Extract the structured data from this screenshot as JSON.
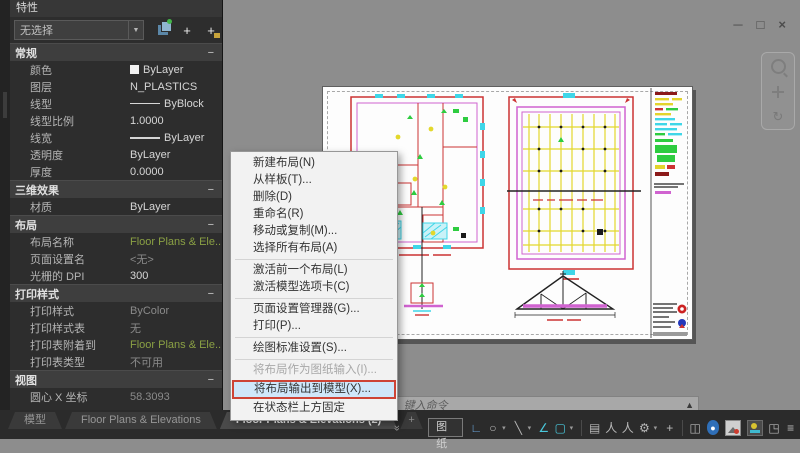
{
  "ui": {
    "collapse": "−",
    "caret": "▾",
    "combo_caret": "▼",
    "prompt": "›",
    "chevron": "«",
    "cursor_tail": "▲"
  },
  "window": {
    "minimize": "─",
    "restore": "□",
    "close": "×"
  },
  "palette": {
    "title": "特性",
    "selector": {
      "value": "无选择"
    },
    "sections": [
      {
        "title": "常规",
        "rows": [
          {
            "label": "颜色",
            "value": "ByLayer"
          },
          {
            "label": "图层",
            "value": "N_PLASTICS"
          },
          {
            "label": "线型",
            "value": "ByBlock"
          },
          {
            "label": "线型比例",
            "value": "1.0000"
          },
          {
            "label": "线宽",
            "value": "ByLayer"
          },
          {
            "label": "透明度",
            "value": "ByLayer"
          },
          {
            "label": "厚度",
            "value": "0.0000"
          }
        ]
      },
      {
        "title": "三维效果",
        "rows": [
          {
            "label": "材质",
            "value": "ByLayer"
          }
        ]
      },
      {
        "title": "布局",
        "rows": [
          {
            "label": "布局名称",
            "value": "Floor Plans & Ele..."
          },
          {
            "label": "页面设置名",
            "value": "<无>"
          },
          {
            "label": "光栅的 DPI",
            "value": "300"
          }
        ]
      },
      {
        "title": "打印样式",
        "rows": [
          {
            "label": "打印样式",
            "value": "ByColor"
          },
          {
            "label": "打印样式表",
            "value": "无"
          },
          {
            "label": "打印表附着到",
            "value": "Floor Plans & Ele..."
          },
          {
            "label": "打印表类型",
            "value": "不可用"
          }
        ]
      },
      {
        "title": "视图",
        "rows": [
          {
            "label": "圆心 X 坐标",
            "value": "58.3093"
          }
        ]
      }
    ]
  },
  "context_menu": {
    "items": [
      {
        "label": "新建布局(N)"
      },
      {
        "label": "从样板(T)..."
      },
      {
        "label": "删除(D)"
      },
      {
        "label": "重命名(R)"
      },
      {
        "label": "移动或复制(M)..."
      },
      {
        "label": "选择所有布局(A)"
      },
      {
        "label": "激活前一个布局(L)"
      },
      {
        "label": "激活模型选项卡(C)"
      },
      {
        "label": "页面设置管理器(G)..."
      },
      {
        "label": "打印(P)..."
      },
      {
        "label": "绘图标准设置(S)..."
      },
      {
        "label": "将布局作为图纸输入(I)...",
        "disabled": true
      },
      {
        "label": "将布局输出到模型(X)...",
        "highlighted": true
      },
      {
        "label": "在状态栏上方固定"
      }
    ]
  },
  "tabs": {
    "items": [
      {
        "label": "模型"
      },
      {
        "label": "Floor Plans & Elevations"
      },
      {
        "label": "Floor Plans & Elevations (2)",
        "active": true
      }
    ],
    "new_tab": "+"
  },
  "command_line": {
    "placeholder": "键入命令"
  },
  "status_bar": {
    "paper_label": "图纸",
    "icons": [
      {
        "name": "snap-mode",
        "glyph": "∟"
      },
      {
        "name": "isodraft",
        "glyph": "○",
        "caret": true
      },
      {
        "name": "ortho-mode",
        "glyph": "╲",
        "caret": true
      },
      {
        "name": "polar-tracking",
        "glyph": "∠"
      },
      {
        "name": "object-snap",
        "glyph": "▢",
        "caret": true
      },
      {
        "name": "annotation-visibility",
        "glyph": "▤"
      },
      {
        "name": "autoscale",
        "glyph": "人"
      },
      {
        "name": "annotation-scale",
        "glyph": "人"
      },
      {
        "name": "workspace-switching",
        "glyph": "⚙",
        "caret": true
      },
      {
        "name": "annotation-monitor",
        "glyph": "+"
      },
      {
        "name": "scale-list",
        "glyph": "◫"
      },
      {
        "name": "graphics-performance",
        "glyph": "●"
      },
      {
        "name": "fullscreen",
        "glyph": "◳"
      },
      {
        "name": "customization",
        "glyph": "≡"
      }
    ]
  },
  "colors": {
    "highlight_bg": "#cfe7fa",
    "annotation_red": "#cd4436",
    "cad_red": "#cc3333",
    "cad_magenta": "#d063d0",
    "cad_yellow": "#e3e332",
    "cad_cyan": "#3fd6e8",
    "cad_green": "#2ecc40",
    "canvas_bg": "#8d8d8d"
  }
}
